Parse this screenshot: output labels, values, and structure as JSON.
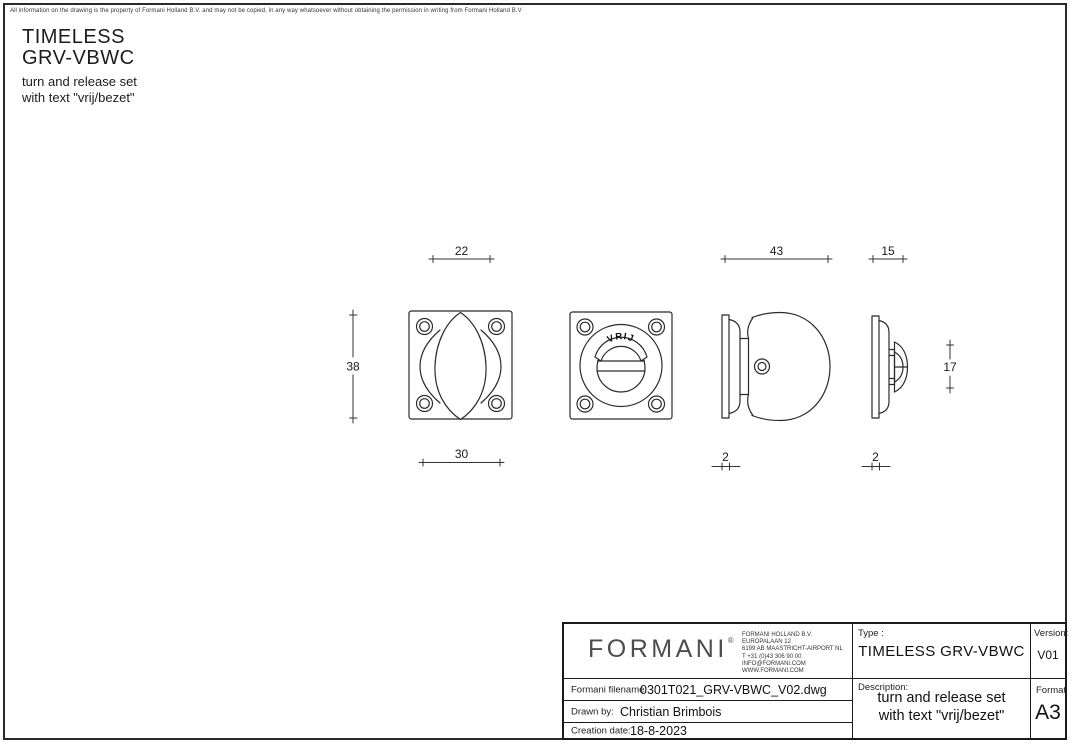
{
  "page": {
    "disclaimer": "All information on the drawing is the property of Formani Holland B.V. and may not be copied, in any way whatsoever without obtaining the permission in writing from Formani Holland B.V",
    "title_line1": "TIMELESS",
    "title_line2": "GRV-VBWC",
    "subtitle_line1": "turn and release set",
    "subtitle_line2": "with text \"vrij/bezet\""
  },
  "drawing": {
    "indicator_text": "VRIJ",
    "dims": {
      "front_width_top": "22",
      "front_height": "38",
      "front_width_bottom": "30",
      "knob_depth": "43",
      "release_depth": "15",
      "release_height": "17",
      "plate_thickness_knob": "2",
      "plate_thickness_release": "2"
    }
  },
  "title_block": {
    "logo": "FORMANI",
    "logo_reg": "®",
    "address_lines": [
      "FORMANI HOLLAND B.V.",
      "EUROPALAAN 12",
      "6199 AB MAASTRICHT-AIRPORT NL",
      "T +31 (0)43 306 90 00",
      "INFO@FORMANI.COM",
      "WWW.FORMANI.COM"
    ],
    "type_label": "Type :",
    "type_value": "TIMELESS GRV-VBWC",
    "version_label": "Version:",
    "version_value": "V01",
    "filename_label": "Formani filename:",
    "filename_value": "0301T021_GRV-VBWC_V02.dwg",
    "drawn_by_label": "Drawn by:",
    "drawn_by_value": "Christian Brimbois",
    "creation_date_label": "Creation date:",
    "creation_date_value": "18-8-2023",
    "description_label": "Description:",
    "description_line1": "turn and release set",
    "description_line2": "with text \"vrij/bezet\"",
    "format_label": "Format",
    "format_value": "A3"
  }
}
